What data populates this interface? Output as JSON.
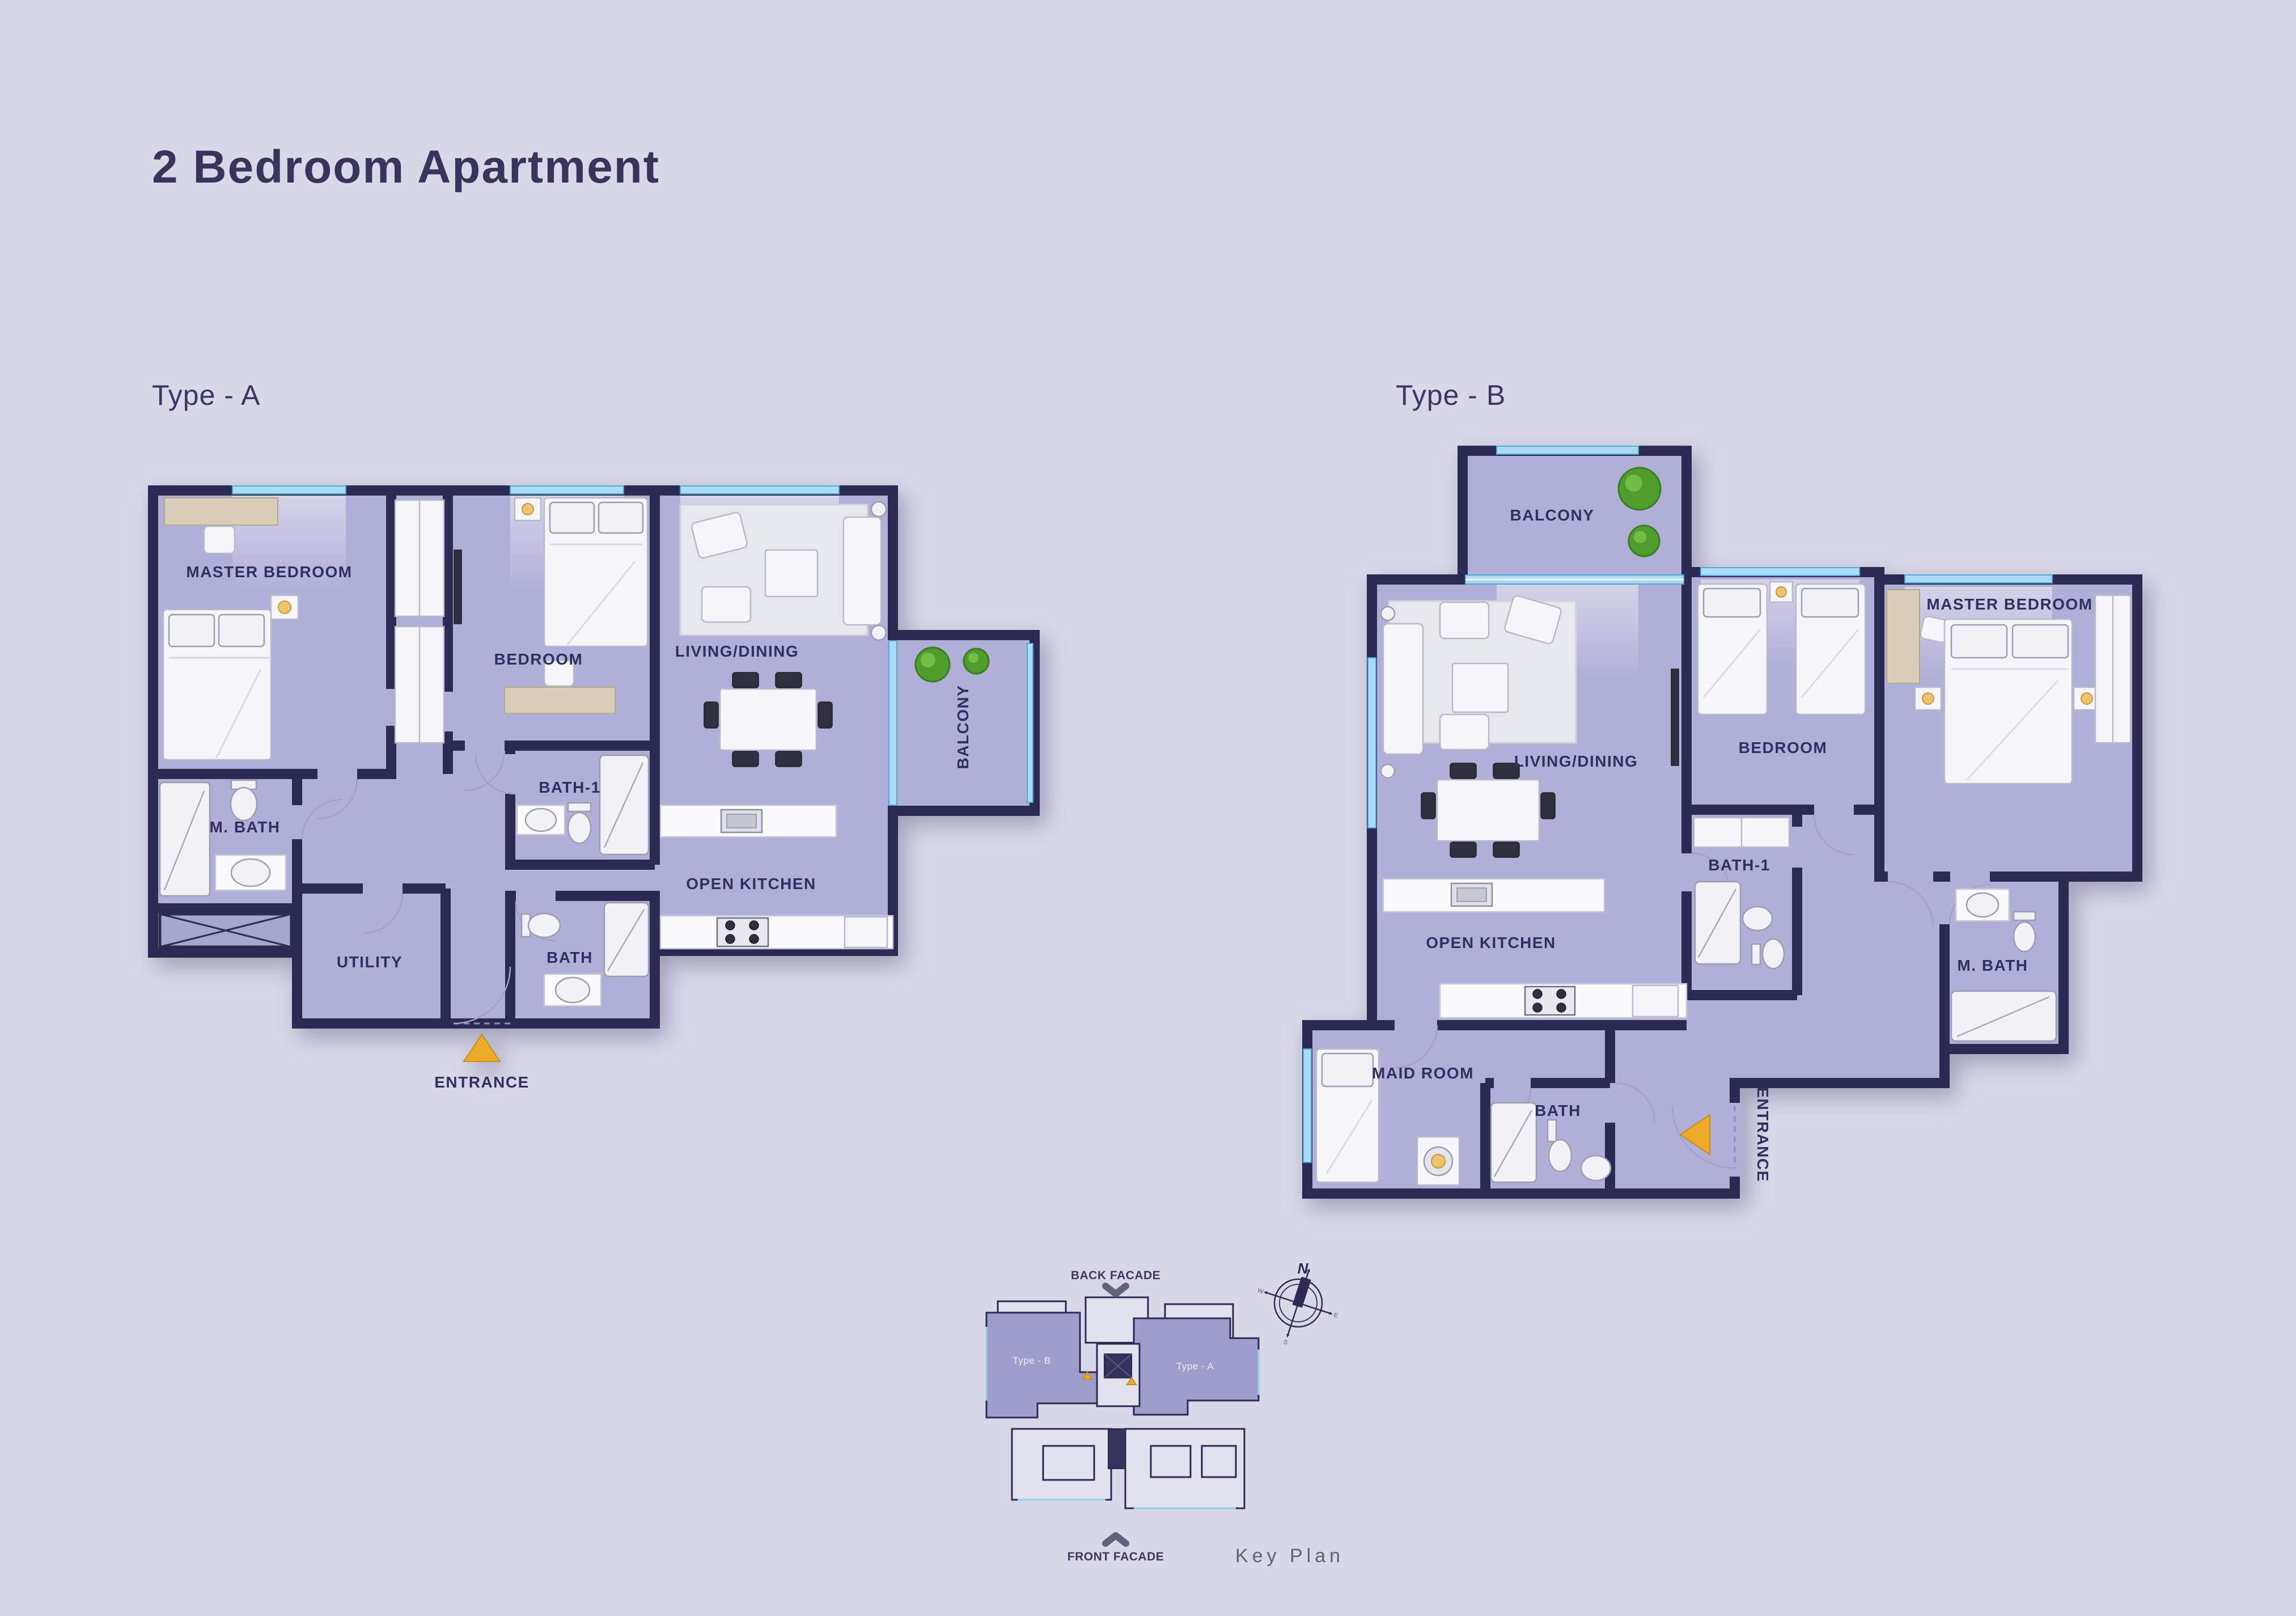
{
  "page": {
    "title": "2 Bedroom Apartment"
  },
  "colors": {
    "background": "#d8d8e9",
    "wall": "#2b2a52",
    "floor": "#b0afd8",
    "room_label": "#2e3160",
    "window_glass": "#a9dcf2",
    "entrance_marker": "#edab2a",
    "balcony_tree": "#4f9d2c",
    "keyplan_unit_highlight": "#9f9dcb",
    "keyplan_text": "#616179"
  },
  "plan_a": {
    "name": "Type - A",
    "rooms": {
      "master_bedroom": "MASTER BEDROOM",
      "bedroom": "BEDROOM",
      "living_dining": "LIVING/DINING",
      "balcony": "BALCONY",
      "m_bath": "M. BATH",
      "bath_1": "BATH-1",
      "utility": "UTILITY",
      "bath": "BATH",
      "open_kitchen": "OPEN KITCHEN",
      "entrance": "ENTRANCE"
    }
  },
  "plan_b": {
    "name": "Type - B",
    "rooms": {
      "balcony": "BALCONY",
      "living_dining": "LIVING/DINING",
      "open_kitchen": "OPEN KITCHEN",
      "maid_room": "MAID ROOM",
      "bath": "BATH",
      "bedroom": "BEDROOM",
      "bath_1": "BATH-1",
      "master_bedroom": "MASTER BEDROOM",
      "m_bath": "M. BATH",
      "entrance": "ENTRANCE"
    }
  },
  "key_plan": {
    "title": "Key Plan",
    "back_facade": "BACK FACADE",
    "front_facade": "FRONT FACADE",
    "unit_b": "Type - B",
    "unit_a": "Type - A",
    "compass_north": "N",
    "compass_west": "W",
    "compass_east": "E",
    "compass_south": "S"
  }
}
